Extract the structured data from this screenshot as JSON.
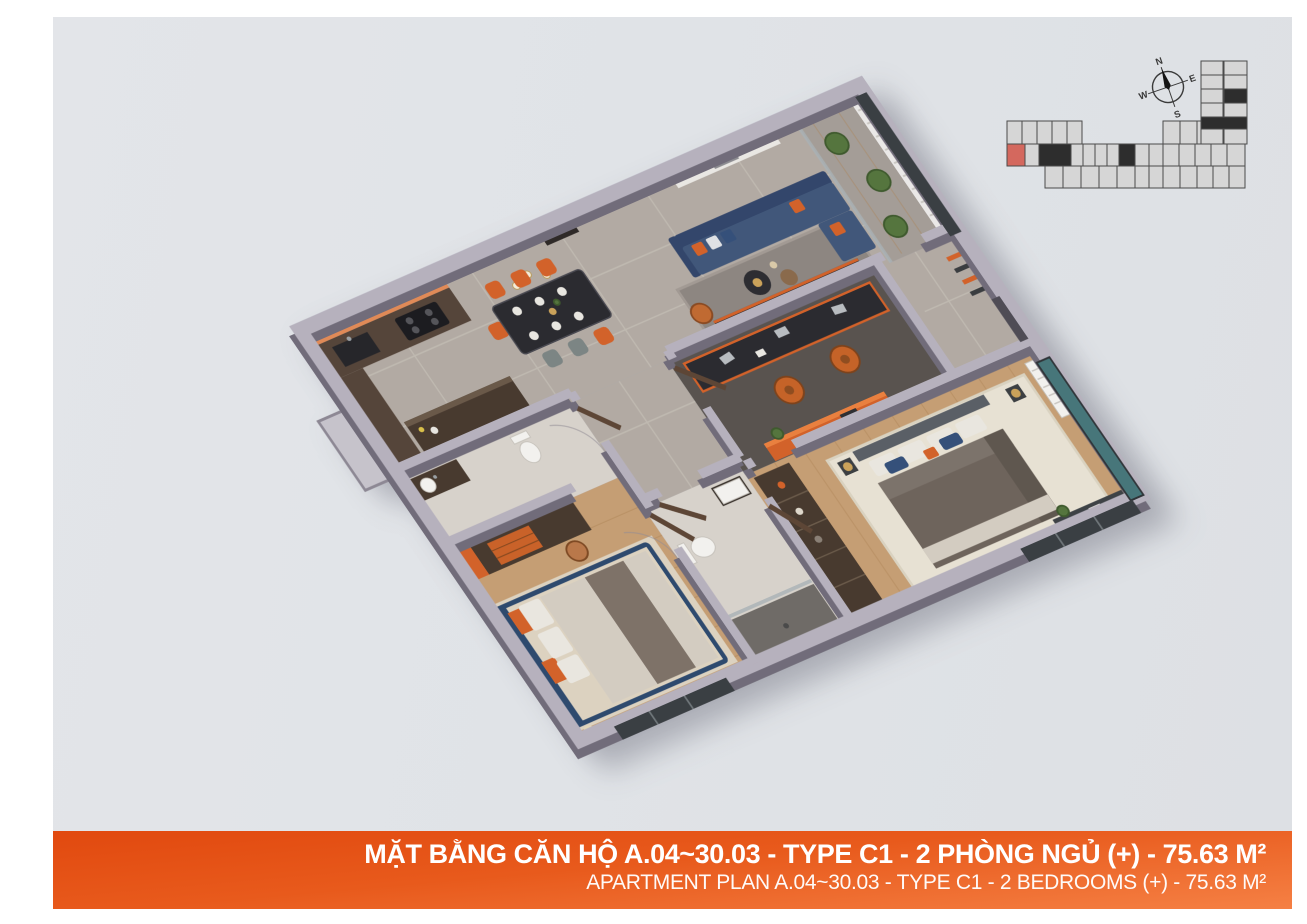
{
  "banner": {
    "title_vi": "MẶT BẰNG CĂN HỘ A.04~30.03 - TYPE C1 - 2 PHÒNG NGỦ (+) - 75.63 M²",
    "title_en": "APARTMENT PLAN A.04~30.03 - TYPE C1 - 2 BEDROOMS (+) - 75.63 M²"
  },
  "compass": {
    "north": "N",
    "east": "E",
    "south": "S",
    "west": "W"
  },
  "locator": {
    "highlighted_unit_color": "#d4685e"
  },
  "colors": {
    "canvas_bg": "#e0e3e7",
    "banner_orange_dark": "#e1490f",
    "banner_orange": "#e85a1c",
    "banner_orange_light": "#f58044",
    "text_white": "#ffffff",
    "wall_top": "#b6b1bd",
    "wall_side": "#716c7a",
    "marble_floor": "#b2aaa3",
    "marble_vein": "#cbc4bc",
    "wood_floor": "#c59e74",
    "wood_line": "#ad8256",
    "tile_floor": "#d7d2cb",
    "dark_floor": "#59534f",
    "balcony_floor": "#a49d97",
    "sofa_navy": "#41577a",
    "sofa_navy_dark": "#33466b",
    "accent_orange": "#d2622a",
    "accent_orange_light": "#e08a57",
    "counter_dark": "#55453a",
    "cabinet_dark": "#483a2f",
    "table_black": "#2b2b30",
    "chair_gray": "#7c8584",
    "rug_gray": "#8d8681",
    "rug_cream": "#e7e1d3",
    "rug_beige": "#dcd2c0",
    "bed_navy": "#2e4a6e",
    "duvet_gray": "#6e645c",
    "duvet_light": "#d3ccc1",
    "blanket_brown": "#7e7268",
    "linen_white": "#e9e6df",
    "pillow_blue": "#35507a",
    "door_wood": "#5d4636",
    "fixture_white": "#f2f1ee",
    "window_teal": "#47767a",
    "window_dark": "#3a3f43",
    "plant_green": "#55753e",
    "plant_dark": "#3f5a2e",
    "metal_gray": "#b8bcc0",
    "gold": "#caa25a",
    "locator_fill": "#d6d6d6",
    "locator_stroke": "#4b4b4b",
    "locator_core": "#2d2d2d",
    "locator_highlight": "#d4685e",
    "compass_ink": "#3a3a3a"
  }
}
